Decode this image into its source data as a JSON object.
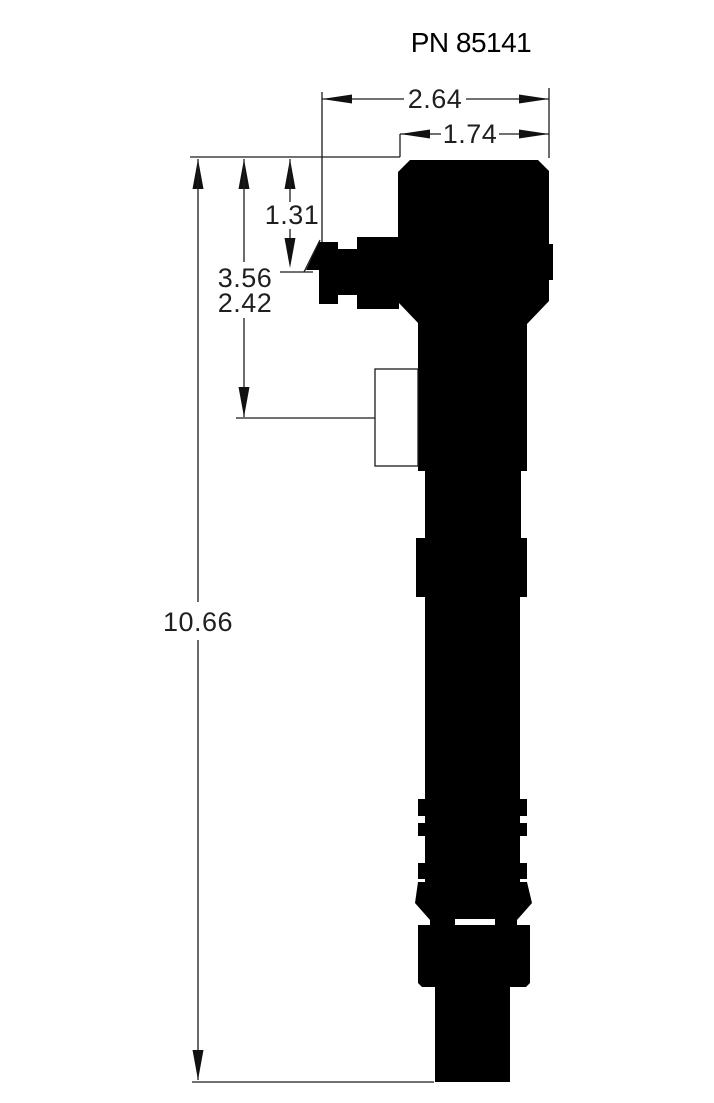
{
  "title": "PN 85141",
  "drawing": {
    "part_number": "PN 85141",
    "dims": {
      "overall_width": "2.64",
      "body_width": "1.74",
      "port_offset": "1.31",
      "bracket_lower": "3.56",
      "bracket_upper": "2.42",
      "overall_length": "10.66"
    },
    "colors": {
      "ink": "#000000",
      "paper": "#ffffff"
    }
  }
}
